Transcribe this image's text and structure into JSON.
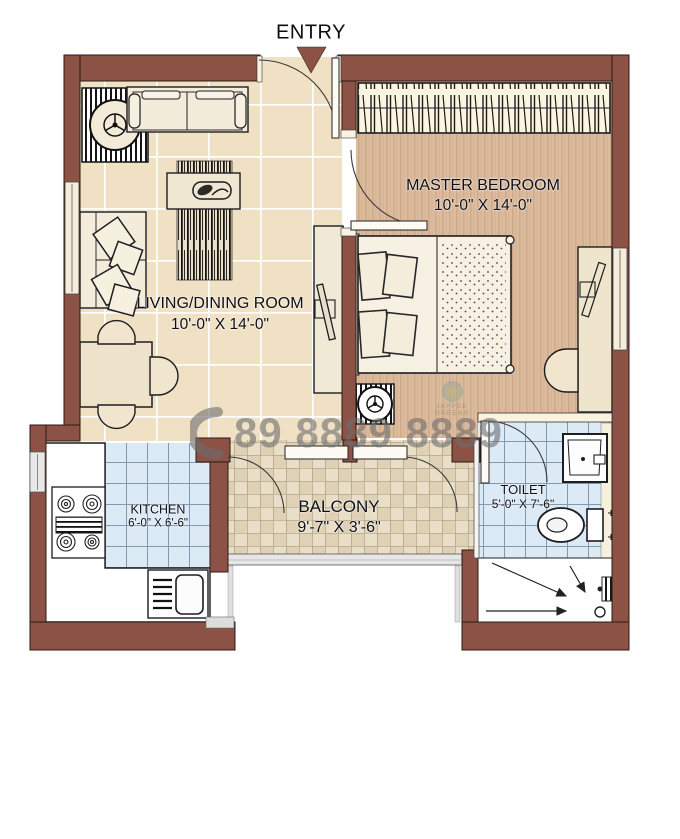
{
  "entry": {
    "label": "ENTRY"
  },
  "rooms": {
    "master_bedroom": {
      "name": "MASTER BEDROOM",
      "dimensions": "10'-0\" X 14'-0\""
    },
    "living_dining": {
      "name": "LIVING/DINING ROOM",
      "dimensions": "10'-0\" X 14'-0\""
    },
    "kitchen": {
      "name": "KITCHEN",
      "dimensions": "6'-0\" X 6'-6\""
    },
    "balcony": {
      "name": "BALCONY",
      "dimensions": "9'-7\" X 3'-6\""
    },
    "toilet": {
      "name": "TOILET",
      "dimensions": "5'-0\" X 7'-6\""
    }
  },
  "watermark": {
    "phone_number": "89 8889 8889",
    "logo_text": "JAYPEE GREENS"
  },
  "colors": {
    "wall": "#8C5245",
    "living_floor": "#F1E1C4",
    "bedroom_floor": "#DDBB9D",
    "wet_tile": "#DCEAF6",
    "balcony_tile": "#E9DFC9",
    "watermark_gray": "#6E6E6E"
  }
}
